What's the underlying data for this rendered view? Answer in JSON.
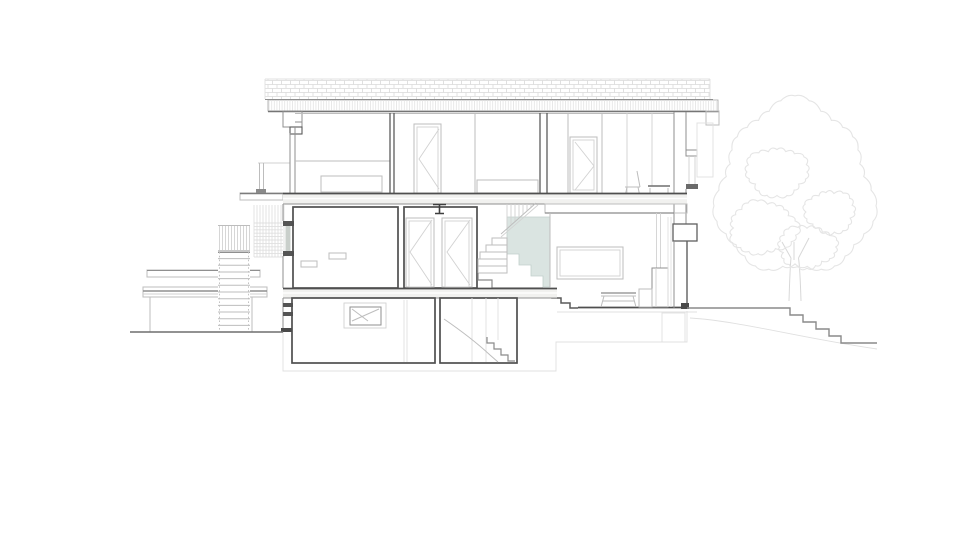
{
  "document": {
    "type": "architectural-section-drawing",
    "view": "building-cross-section-elevation",
    "background": "#ffffff",
    "visible_text": []
  },
  "colors": {
    "dark": "#4f4f4f",
    "ground": "#6e6e6e",
    "mid": "#8f8f8f",
    "light": "#bdbdbd",
    "xlight": "#d2d2d2",
    "faint": "#e0e0e0",
    "tree": "#e5e5e5",
    "stair_fill": "#dae4e1",
    "slab_fill": "#f1f1ef",
    "glass_fill": "#c9cfcb",
    "hatch": "#d9d9d9"
  },
  "scene": {
    "levels": [
      {
        "name": "upper-floor",
        "rooms": [
          "bedroom-left",
          "bedroom-middle",
          "bedroom-right"
        ]
      },
      {
        "name": "entry-level",
        "rooms": [
          "room-left",
          "hallway-with-two-doors",
          "staircase",
          "living-room"
        ]
      },
      {
        "name": "basement",
        "rooms": [
          "cellar-room-with-window",
          "basement-stair-room"
        ]
      }
    ],
    "exterior": [
      "flat-roof-with-hatch",
      "roof-slab-band",
      "external-stair-with-balustrade",
      "trellis-screen",
      "garage-annex",
      "entry-canopy",
      "downpipe",
      "deciduous-tree",
      "terrain-steps-right",
      "ground-line-left",
      "foundation-outline"
    ],
    "furniture": [
      "dresser",
      "bed",
      "desk-chair",
      "desk",
      "wall-picture-window",
      "coffee-table",
      "sideboard",
      "stove-with-flue"
    ],
    "symbols": [
      "steel-beam-section",
      "door-swing-triangles",
      "tilt-window-symbol"
    ]
  }
}
